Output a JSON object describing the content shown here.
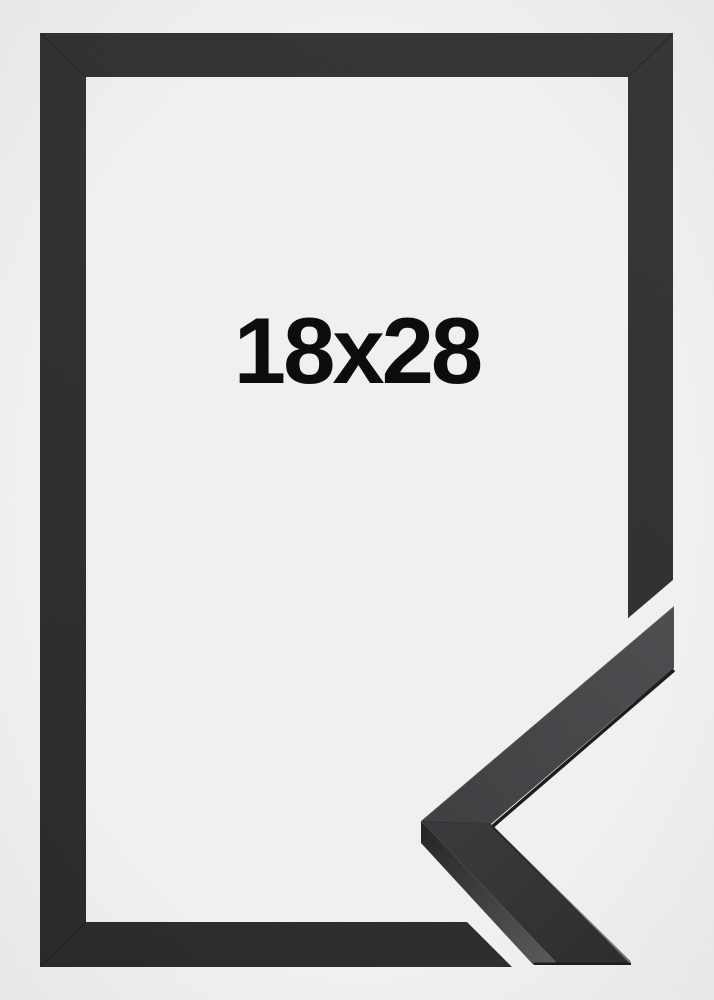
{
  "photo": {
    "size_label": "18x28",
    "colors": {
      "background": "#f1f1f2",
      "label_text": "#0a0a0a",
      "frame_light": "#353537",
      "frame_dark": "#29292b",
      "detail_face_light": "#4d4d50",
      "detail_face_mid": "#3e3e41",
      "detail_face_dark_top": "#38383b",
      "detail_face_dark_bottom": "#2d2d2f",
      "detail_side_dark": "#242426",
      "detail_side_light": "#58585a",
      "detail_bevel": "#1b1b1d"
    }
  }
}
